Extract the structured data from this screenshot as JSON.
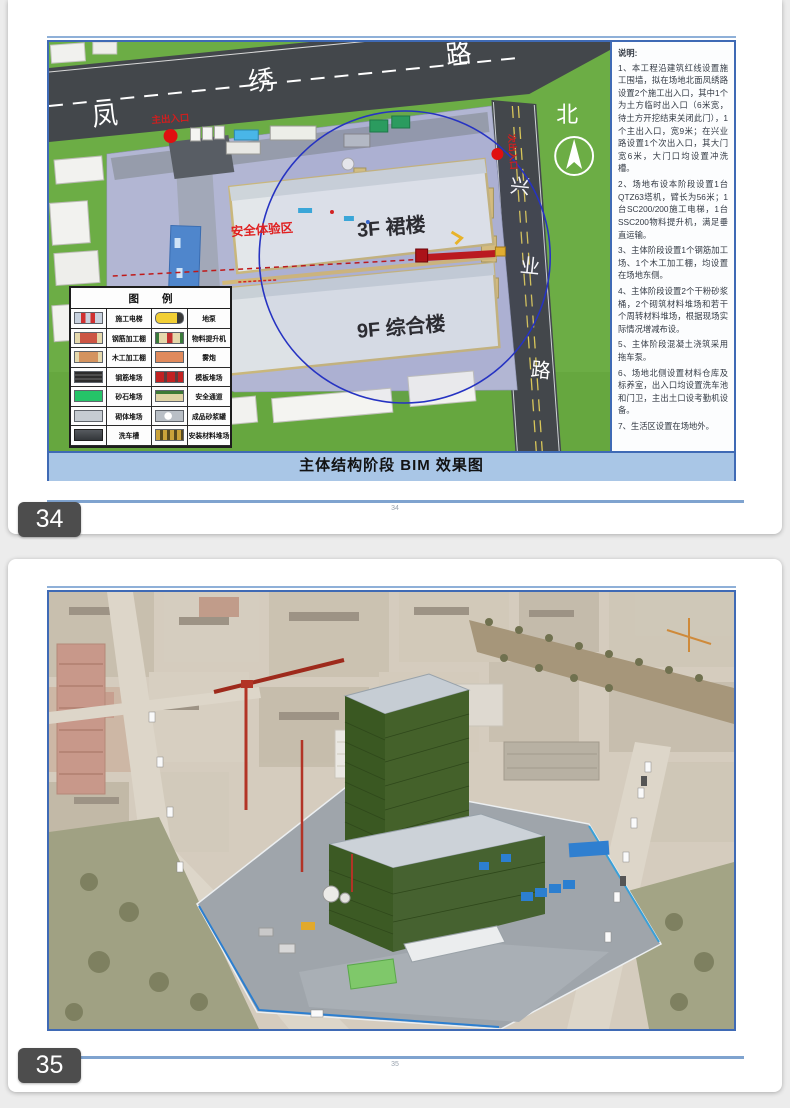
{
  "page34": {
    "badge": "34",
    "footer_number": "34",
    "caption": "主体结构阶段 BIM 效果图",
    "plan": {
      "road_north_chars": [
        "凤",
        "绣",
        "路"
      ],
      "road_east_chars": [
        "兴",
        "业",
        "路"
      ],
      "north_label": "北",
      "building_podium": "3F  裙楼",
      "building_main": "9F  综合楼",
      "safety_zone_label": "安全体验区",
      "main_gate_label": "主出入口",
      "side_gate_label": "次出入口"
    },
    "legend": {
      "title": "图 例",
      "rows": [
        {
          "left": "施工电梯",
          "right": "地泵"
        },
        {
          "left": "钢筋加工棚",
          "right": "物料提升机"
        },
        {
          "left": "木工加工棚",
          "right": "雾炮"
        },
        {
          "left": "钢筋堆场",
          "right": "模板堆场"
        },
        {
          "left": "砂石堆场",
          "right": "安全通道"
        },
        {
          "left": "砌体堆场",
          "right": "成品砂浆罐"
        },
        {
          "left": "洗车槽",
          "right": "安装材料堆场"
        }
      ]
    },
    "notes": {
      "title": "说明:",
      "items": [
        "1、本工程沿建筑红线设置施工围墙，拟在场地北面凤绣路设置2个施工出入口，其中1个为土方临时出入口（6米宽，待土方开挖结束关闭此门），1个主出入口，宽9米；在兴业路设置1个次出入口，其大门宽6米，大门口均设置冲洗槽。",
        "2、场地布设本阶段设置1台QTZ63塔机，臂长为56米；1台SC200/200施工电梯，1台SSC200物料提升机，满足垂直运输。",
        "3、主体阶段设置1个钢筋加工场、1个木工加工棚，均设置在场地东侧。",
        "4、主体阶段设置2个干粉砂浆桶，2个砌筑材料堆场和若干个周转材料堆场，根据现场实际情况增减布设。",
        "5、主体阶段混凝土浇筑采用拖车泵。",
        "6、场地北侧设置材料仓库及标养室，出入口均设置洗车池和门卫，主出土口设考勤机设备。",
        "7、生活区设置在场地外。"
      ]
    }
  },
  "page35": {
    "badge": "35",
    "footer_number": "35"
  },
  "colors": {
    "accent_blue": "#3F6AB5",
    "caption_bg": "#A9C6E6",
    "badge_bg": "#4D4D4D",
    "grass_green": "#6CAD45",
    "road_dark": "#43474B",
    "site_ground": "#B2B6D3",
    "crane_red": "#C01818",
    "safety_label_red": "#E02020",
    "mesh_green": "#3A5822"
  }
}
